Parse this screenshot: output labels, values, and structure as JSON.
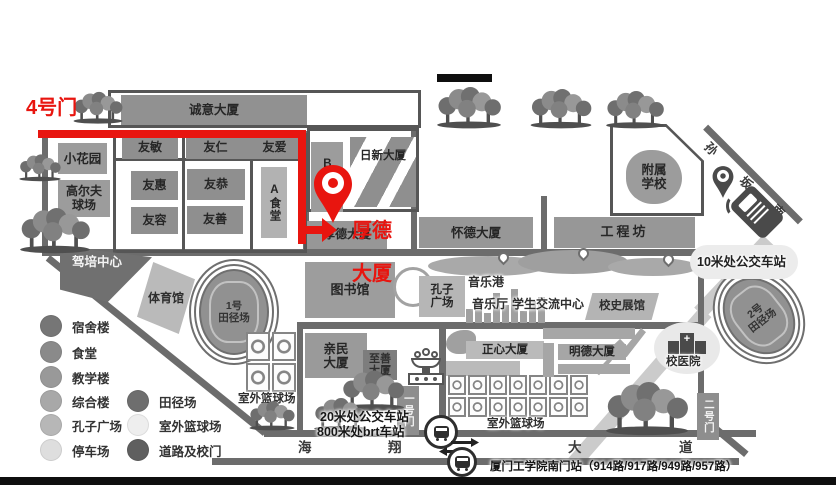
{
  "colors": {
    "red": "#e8150f",
    "road": "#6c6c6c",
    "road_light": "#cbcbcb",
    "black_bar": "#0f0f0f"
  },
  "red_annotation": {
    "gate": "4号门",
    "dest_l1": "厚德",
    "dest_l2": "大厦"
  },
  "campus": {
    "north": {
      "chengyi": "诚意大厦",
      "garden": "小花园",
      "golf": "高尔夫球场",
      "youmin": "友敏",
      "youren": "友仁",
      "youai": "友爱",
      "youhui": "友惠",
      "yougong": "友恭",
      "yourong": "友容",
      "youshan": "友善",
      "canteen_a": "A食堂",
      "canteen_b": "B食堂",
      "rixin": "日新大厦",
      "fushu_l1": "附属",
      "fushu_l2": "学校"
    },
    "mid": {
      "houde": "厚德大厦",
      "huaide": "怀德大厦",
      "gongchengfang": "工程坊",
      "jiapei": "驾培中心",
      "gym": "体育馆",
      "track1_l1": "1号",
      "track1_l2": "田径场",
      "library": "图书馆",
      "kongzi_l1": "孔子",
      "kongzi_l2": "广场",
      "music_port": "音乐港",
      "music_hall": "音乐厅",
      "student_center": "学生交流中心",
      "history_hall": "校史展馆"
    },
    "south": {
      "qinmin_l1": "亲民",
      "qinmin_l2": "大厦",
      "zhishan_l1": "至善",
      "zhishan_l2": "大厦",
      "zhengxin": "正心大厦",
      "mingde": "明德大厦",
      "hospital": "校医院",
      "bball_left": "室外篮球场",
      "bball_right": "室外篮球场",
      "gate1": "一号门",
      "gate2": "二号门",
      "track2_l1": "2号",
      "track2_l2": "田径场",
      "bus20": "20米处公交车站",
      "brt800": "800米处brt车站"
    },
    "east": {
      "bus10": "10米处公交车站",
      "road_char1": "孙",
      "road_char2": "坂",
      "road_char3": "南"
    },
    "south_road": {
      "char1": "海",
      "char2": "翔",
      "char3": "大",
      "char4": "道",
      "station": "厦门工学院南门站（914路/917路/949路/957路）"
    }
  },
  "legend": {
    "left": [
      {
        "label": "宿舍楼",
        "color": "#767676"
      },
      {
        "label": "食堂",
        "color": "#8a8a8a"
      },
      {
        "label": "教学楼",
        "color": "#999999"
      },
      {
        "label": "综合楼",
        "color": "#a8a8a8"
      },
      {
        "label": "孔子广场",
        "color": "#b7b7b7"
      },
      {
        "label": "停车场",
        "color": "#dedede"
      }
    ],
    "right": [
      {
        "label": "田径场",
        "color": "#6e6e6e"
      },
      {
        "label": "室外篮球场",
        "color": "#eeeeee"
      },
      {
        "label": "道路及校门",
        "color": "#5f5f5f"
      }
    ]
  }
}
